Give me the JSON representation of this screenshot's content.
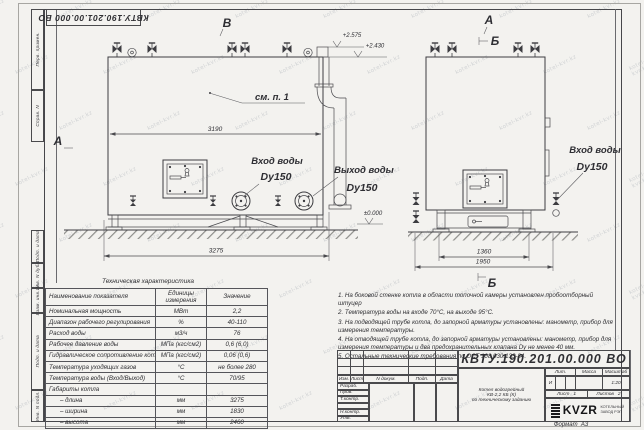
{
  "watermark": "kotel-kvr.kz",
  "top_stamp": "КВТУ.190.201.00.000 ВО",
  "side_strip": {
    "labels": [
      "Перв. примен.",
      "Справ. N",
      "Подп. и дата",
      "Инв. N дубл.",
      "Взам. инв. N",
      "Подп. и дата",
      "Инв. N подл."
    ]
  },
  "views": {
    "left": {
      "marker_top": "В",
      "marker_section": "А",
      "dim_width": "3190",
      "dim_overall": "3275",
      "inlet": "Вход воды",
      "inlet_dn": "Dy150",
      "outlet": "Выход воды",
      "outlet_dn": "Dy150",
      "see_note": "см. п. 1",
      "elev_top": "+2.575",
      "elev_mid": "+2.430",
      "elev_zero": "±0.000"
    },
    "right": {
      "marker_a": "А",
      "marker_b": "Б",
      "marker_b_bottom": "Б",
      "dim_supports": "1360",
      "dim_overall": "1950",
      "inlet": "Вход воды",
      "inlet_dn": "Dy150"
    }
  },
  "spec_table": {
    "title": "Техническая характеристика",
    "headers": {
      "name": "Наименование показателя",
      "units_line1": "Единицы",
      "units_line2": "измерения",
      "value": "Значение"
    },
    "rows": [
      [
        "Номинальная мощность",
        "МВт",
        "2,2"
      ],
      [
        "Диапазон рабочего регулирования",
        "%",
        "40-110"
      ],
      [
        "Расход воды",
        "м3/ч",
        "76"
      ],
      [
        "Рабочее давление воды",
        "МПа (кгс/см2)",
        "0,6 (6,0)"
      ],
      [
        "Гидравлическое сопротивление котла",
        "МПа (кгс/см2)",
        "0,06 (0,6)"
      ],
      [
        "Температура уходящих газов",
        "°С",
        "не более 280"
      ],
      [
        "Температура воды (Вход/Выход)",
        "°С",
        "70/95"
      ],
      [
        "Габариты котла",
        "",
        ""
      ],
      [
        "– длина",
        "мм",
        "3275"
      ],
      [
        "– ширина",
        "мм",
        "1830"
      ],
      [
        "– высота",
        "мм",
        "2460"
      ]
    ]
  },
  "notes": [
    "1.  На боковой стенке котла в области топочной камеры установлен пробоотборный штуцер",
    "2.  Температура воды на входе 70°С, на выходе 95°С.",
    "3.  На подводящей трубе котла, до запорной арматуры установлены: манометр, прибор для измерения температуры.",
    "4.  На отводящей трубе котла, до запорной арматуры установлены: манометр, прибор для измерения температуры и два предохранительных клапана  Dу не менее 40 мм.",
    "5.  Остальные технические требования по ОСТ 108.030.133-84."
  ],
  "title_block": {
    "doc_number": "КВТУ.190.201.00.000  ВО",
    "rev_header": [
      "Изм.",
      "Лист",
      "N докум.",
      "Подп.",
      "Дата"
    ],
    "side_rows": [
      "Разраб.",
      "Пров.",
      "Т.контр.",
      "",
      "Н.контр.",
      "Утв."
    ],
    "description_line1": "Котел водогрейный",
    "description_line2": "КВ-2,2 КБ (К)",
    "description_line3": "по техническому заданию",
    "lit_header": [
      "Лит.",
      "Масса",
      "Масштаб"
    ],
    "lit_value": "И",
    "mass_value": "",
    "scale_value": "1:20",
    "sheet_label": "Лист",
    "sheet_value": "1",
    "sheets_label": "Листов",
    "sheets_value": "2",
    "logo_text": "KVZR",
    "logo_sub1": "КОТЕЛЬНЫЙ",
    "logo_sub2": "ЗАВОД РЭП",
    "format_note": "Формат  А3"
  }
}
